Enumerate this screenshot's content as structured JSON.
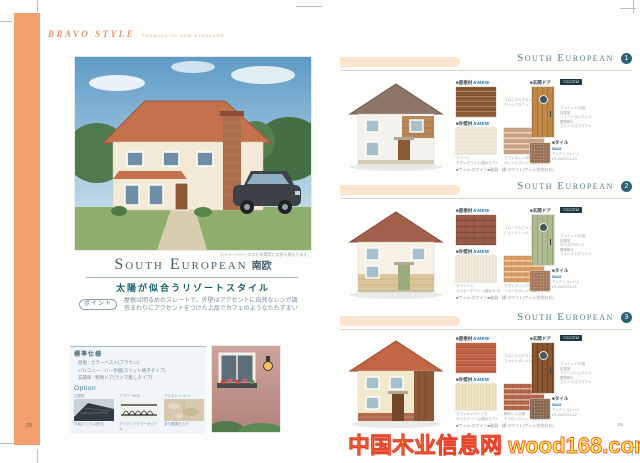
{
  "colors": {
    "accent_orange": "#F3A06E",
    "title_teal": "#46616F",
    "subtitle_teal": "#15606B",
    "section_badge_teal": "#2C6375",
    "kmew_blue": "#1565B0",
    "watermark_yellow": "#FFEB4A",
    "watermark_red": "#E8432C"
  },
  "header": {
    "brand": "BRAVO STYLE",
    "tagline": "FORMULA OF NEW STANDARD"
  },
  "pages": {
    "left_number": "05",
    "right_number": "06"
  },
  "watermark": "中国木业信息网 wood168.com",
  "left_page": {
    "image_caption": "※イメージパースのため実際とは多少異なります。",
    "title_en": "South European",
    "title_jp": "南欧",
    "subtitle": "太陽が似合うリゾートスタイル",
    "point_label": "ポイント",
    "point_text": "屋根は明るめのスレートで、外壁はアクセントに自然なレンガ調\n窓まわりにアクセントをつけた上品でカフェのようなたたずまい",
    "spec": {
      "heading": "標準仕様",
      "rows": [
        "屋根 : カラーベスト(ブラウン)",
        "バルコニー : バー手摺(スリット格子タイプ)",
        "玄関扉 : 断熱ドア(ランマ無しタイプ)"
      ],
      "option_heading": "Option",
      "options": [
        {
          "label": "瓦屋根",
          "caption": "洋瓦(ミックス葺き)"
        },
        {
          "label": "フラワーBOX",
          "caption": "アイアンフラワーボックス"
        },
        {
          "label": "アクセントコート",
          "caption": "塗り壁調仕上げ"
        }
      ]
    }
  },
  "sections": [
    {
      "title": "South European",
      "number": "1",
      "roof_label": "■屋根材",
      "roof_brand": "KMEW",
      "roof_caption": "コロニアルグランデ\nクールブラウン",
      "wall_label": "■外壁材",
      "wall_brand": "KMEW",
      "wall1_caption": "クリート\nチタンホワイト(親水セラ)",
      "wall2_caption": "ラフィネレンガ調\nオレンジブレンド(親水セラ)",
      "door_label": "■玄関ドア",
      "door_brand": "TOSTEM",
      "door_caption": "ファミット7D型\n採風窓\nニュートラルウッド\n鋳物飾り\nプレシャスブラウン",
      "tile_label": "■タイル",
      "tile_brand": "INAX",
      "tile_caption": "アンティコレート\nHT-200/COL-13",
      "footnote": "■サッシ:ホワイト■破風・樋:ホワイト(サッシ色合わせ)"
    },
    {
      "title": "South European",
      "number": "2",
      "roof_label": "■屋根材",
      "roof_brand": "KMEW",
      "roof_caption": "コロニアルクァッド\nシェイドレッド",
      "wall_label": "■外壁材",
      "wall_brand": "KMEW",
      "wall1_caption": "セラトーン\nミルキーホワイト(親水セラ)",
      "wall2_caption": "モダンブリックⅡ\nリモーネオレンジ(親水セラ)",
      "door_label": "■玄関ドア",
      "door_brand": "TOSTEM",
      "door_caption": "ファミット5C型\n採風窓\nガラスデザイン\n鋳物飾り\nフォレストグリーン",
      "tile_label": "■タイル",
      "tile_brand": "INAX",
      "tile_caption": "アンティコレート\nHT-200/COL-21",
      "footnote": "■サッシ:ホワイト■破風・樋:ホワイト(サッシ色合わせ)"
    },
    {
      "title": "South European",
      "number": "3",
      "roof_label": "■屋根材",
      "roof_brand": "KMEW",
      "roof_caption": "コロニアルグランデ\nファインオレンジ",
      "wall_label": "■外壁材",
      "wall_brand": "KMEW",
      "wall1_caption": "モエンサイディング\nサンドクリーム(親水セラ)",
      "wall2_caption": "積みレンガ調\nテラロッソレッド(親水セラ)",
      "door_label": "■玄関ドア",
      "door_brand": "TOSTEM",
      "door_caption": "ファミット7F型\n採風窓\nアイリッシュパイン\n鋳物飾り\nプレシャスブラウン",
      "tile_label": "■タイル",
      "tile_brand": "INAX",
      "tile_caption": "アンティコレート\nHT-200/COL-12",
      "footnote": "■サッシ:ホワイト■破風・樋:ホワイト(サッシ色合わせ)"
    }
  ]
}
